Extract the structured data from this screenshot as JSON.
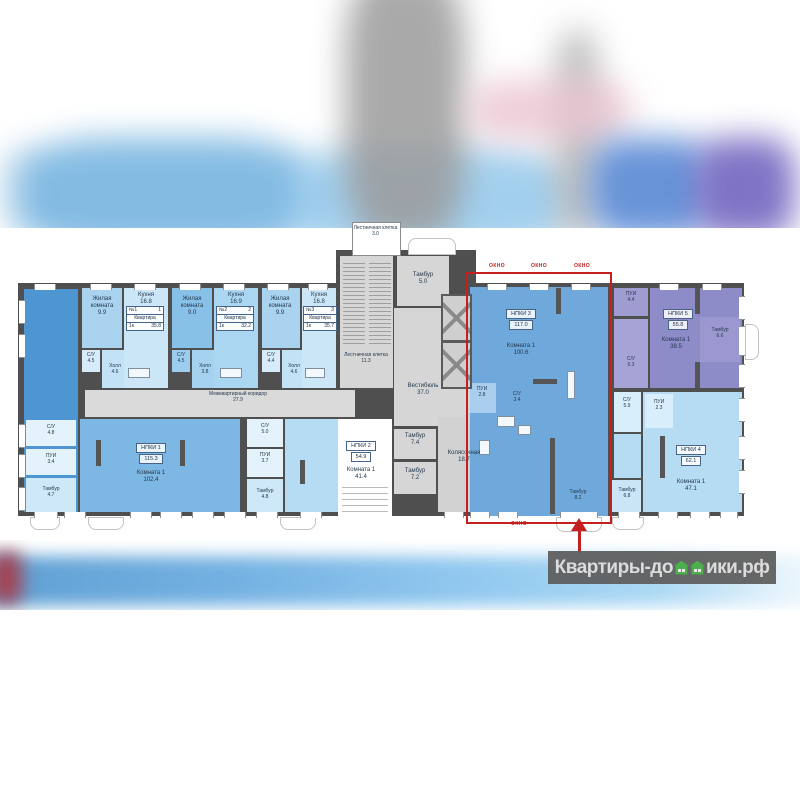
{
  "watermark": {
    "prefix": "Квартиры-до",
    "suffix": "ики.рф"
  },
  "plan": {
    "okno": "ОКНО",
    "core": {
      "stair_small": {
        "label": "Лестничная клетка",
        "area": "3.0"
      },
      "tambur_top": {
        "label": "Тамбур",
        "area": "5.0"
      },
      "stair_main": {
        "label": "Лестничная клетка",
        "area": "11.3"
      },
      "vestibule": {
        "label": "Вестибюль",
        "area": "37.0"
      },
      "tambur_a": {
        "label": "Тамбур",
        "area": "7.4"
      },
      "tambur_b": {
        "label": "Тамбур",
        "area": "7.2"
      },
      "stroller": {
        "label": "Колясочная",
        "area": "18.7"
      },
      "corridor": {
        "label": "Межквартирный коридор",
        "area": "27.9"
      }
    },
    "apartments": [
      {
        "num": "№1",
        "idx": "1",
        "title": "Квартира",
        "type": "1к",
        "total": "35.8",
        "living": {
          "label": "Жилая комната",
          "area": "9.9"
        },
        "kitchen": {
          "label": "Кухня",
          "area": "16.8"
        },
        "wc": {
          "label": "С/У",
          "area": "4.5"
        },
        "hall": {
          "label": "Холл",
          "area": "4.6"
        }
      },
      {
        "num": "№2",
        "idx": "2",
        "title": "Квартира",
        "type": "1к",
        "total": "32.2",
        "living": {
          "label": "Жилая комната",
          "area": "9.0"
        },
        "kitchen": {
          "label": "Кухня",
          "area": "16.9"
        },
        "wc": {
          "label": "С/У",
          "area": "4.5"
        },
        "hall": {
          "label": "Холл",
          "area": "3.8"
        }
      },
      {
        "num": "№3",
        "idx": "3",
        "title": "Квартира",
        "type": "1к",
        "total": "35.7",
        "living": {
          "label": "Жилая комната",
          "area": "9.9"
        },
        "kitchen": {
          "label": "Кухня",
          "area": "16.8"
        },
        "wc": {
          "label": "С/У",
          "area": "4.4"
        },
        "hall": {
          "label": "Холл",
          "area": "4.6"
        }
      }
    ],
    "units": [
      {
        "name": "НПКИ 1",
        "total": "115.3",
        "room": "Комната 1",
        "room_area": "102.4",
        "wc": "С/У",
        "wc_area": "4.8",
        "pui": "ПУИ",
        "pui_area": "3.4",
        "tambur": "Тамбур",
        "tambur_area": "4.7"
      },
      {
        "name": "НПКИ 2",
        "total": "54.9",
        "room": "Комната 1",
        "room_area": "41.4",
        "wc": "С/У",
        "wc_area": "5.0",
        "pui": "ПУИ",
        "pui_area": "3.7",
        "tambur": "Тамбур",
        "tambur_area": "4.8"
      },
      {
        "name": "НПКИ 3",
        "total": "117.0",
        "room": "Комната 1",
        "room_area": "100.6",
        "wc": "С/У",
        "wc_area": "3.4",
        "pui": "ПУИ",
        "pui_area": "2.8",
        "tambur": "Тамбур",
        "tambur_area": "8.2"
      },
      {
        "name": "НПКИ 4",
        "total": "62.1",
        "room": "Комната 1",
        "room_area": "47.1",
        "wc": "С/У",
        "wc_area": "5.9",
        "pui": "ПУИ",
        "pui_area": "2.3",
        "tambur": "Тамбур",
        "tambur_area": "6.8"
      },
      {
        "name": "НПКИ 5",
        "total": "55.8",
        "room": "Комната 1",
        "room_area": "38.5",
        "wc": "С/У",
        "wc_area": "6.3",
        "pui": "ПУИ",
        "pui_area": "4.4",
        "tambur": "Тамбур",
        "tambur_area": "6.6"
      }
    ]
  }
}
